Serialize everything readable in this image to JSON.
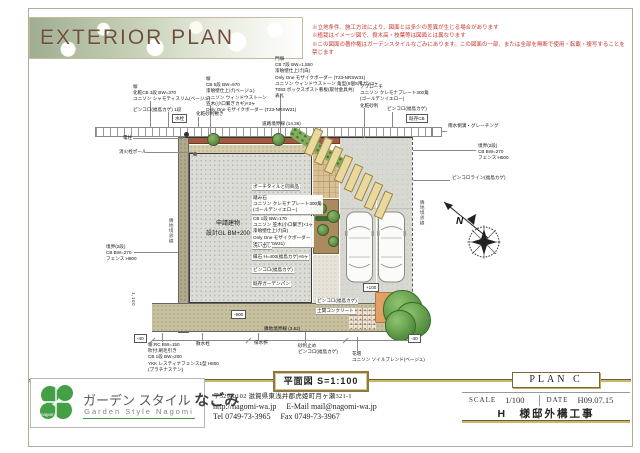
{
  "title": "EXTERIOR PLAN",
  "notes": [
    "※立地条件、施工方法により、図面とは多少の差異が生じる場合があります",
    "※植栽はイメージ図で、樹木高・枝葉等は図面とは異なります",
    "※この図面の著作権はガーデンスタイルなごみにあります。この図面の一部、または全部を無断で使用・転載・複写することを禁じます"
  ],
  "drawing_label": "平面図  S=1:100",
  "compass_north": "N",
  "plan": {
    "annotations": [
      {
        "t": "塀\n化粧CB 3段 BW=370\nユニソン シャモティスリム(ベージュ)",
        "x": 133,
        "y": 84
      },
      {
        "t": "ピンコロ(福島カゲ) 1段",
        "x": 133,
        "y": 107
      },
      {
        "t": "塀\nCB 5段 BW=970\n漆喰壁仕上げ(ベージュ)\nユニソン ウィンドウストーン\n笠木(小口繋ぎカギ)×3ヶ\nOnly One モザイクボーダー (T23-NRSW31)",
        "x": 206,
        "y": 76
      },
      {
        "t": "門塀\nCB 7段 BW=1,550\n漆喰壁仕上げ(白)\nOnly One モザイクボーダー (T23-NRSW31)\nユニソン ウィンドウストーン 角型(6個S用ガ)×3ヶ\nT083 ボックスポスト看板(取付金具共)\n表札",
        "x": 275,
        "y": 56
      },
      {
        "t": "アプローチ\nユニソン クレモナプレート300角\n(ゴールデンイエロー)\n化粧砂利",
        "x": 360,
        "y": 84
      },
      {
        "t": "化粧砂利敷き",
        "x": 196,
        "y": 111
      },
      {
        "t": "ピンコロ(福島カゲ)",
        "x": 387,
        "y": 106
      },
      {
        "t": "既存CB",
        "x": 406,
        "y": 114,
        "cls": "box"
      },
      {
        "t": "水栓",
        "x": 172,
        "y": 114,
        "cls": "box"
      },
      {
        "t": "電柱",
        "x": 123,
        "y": 135
      },
      {
        "t": "消火栓ポール",
        "x": 119,
        "y": 149
      },
      {
        "t": "道路境界線 (14.36)",
        "x": 262,
        "y": 121
      },
      {
        "t": "雨水側溝・グレーチング",
        "x": 448,
        "y": 123
      },
      {
        "t": "境界(2段)\nCB BW=270\nフェンス H500",
        "x": 478,
        "y": 143
      },
      {
        "t": "ピンコロライン(福島カゲ)",
        "x": 452,
        "y": 175
      },
      {
        "t": "隣地境界線",
        "x": 419,
        "y": 200,
        "cls": "vert"
      },
      {
        "t": "隣地境界線",
        "x": 168,
        "y": 218,
        "cls": "vert"
      },
      {
        "t": "境界(2段)\nCB BW=270\nフェンス H800",
        "x": 106,
        "y": 244
      },
      {
        "t": "1,100",
        "x": 130,
        "y": 292,
        "cls": "vert"
      },
      {
        "t": "申請建物\n設計GL BM+200",
        "x": 206,
        "y": 220,
        "cls": "c"
      },
      {
        "t": "ポーチタイルと同商品",
        "x": 252,
        "y": 184,
        "cls": "w"
      },
      {
        "t": "踏み石\nユニソン クレモナプレート300角\n(ゴールデンイエロー)",
        "x": 252,
        "y": 195,
        "cls": "w"
      },
      {
        "t": "CB 1段 BW=170\nユニソン 笠木(小口繋ぎ)×1ヶ\n漆喰壁仕上げ(白)\nOnly One モザイクボーダー\n(T23-NRSW31)",
        "x": 252,
        "y": 216,
        "cls": "w"
      },
      {
        "t": "洗い出し",
        "x": 252,
        "y": 243,
        "cls": "w"
      },
      {
        "t": "縁石 H=400(福島カゲ)×6ヶ",
        "x": 252,
        "y": 254,
        "cls": "w"
      },
      {
        "t": "ピンコロ(福島カゲ)",
        "x": 252,
        "y": 267,
        "cls": "w"
      },
      {
        "t": "既存ガーデンパン",
        "x": 252,
        "y": 281,
        "cls": "w"
      },
      {
        "t": "ピンコロ(福島カゲ)",
        "x": 316,
        "y": 298,
        "cls": "w"
      },
      {
        "t": "土間コンクリート",
        "x": 316,
        "y": 308,
        "cls": "w"
      },
      {
        "t": "+100",
        "x": 363,
        "y": 283,
        "cls": "box"
      },
      {
        "t": "-900",
        "x": 231,
        "y": 310,
        "cls": "box"
      },
      {
        "t": "-40",
        "x": 134,
        "y": 334,
        "cls": "box"
      },
      {
        "t": "-40",
        "x": 408,
        "y": 334,
        "cls": "box"
      },
      {
        "t": "隣地境界線 (3.62)",
        "x": 264,
        "y": 326
      },
      {
        "t": "塀:RC BW=150\n吹付:刷毛引き\nCB 1段 BW=200\nYKK レスティナフェンス1型 H800\n(プラチナステン)",
        "x": 148,
        "y": 342
      },
      {
        "t": "散水栓",
        "x": 196,
        "y": 341
      },
      {
        "t": "排水桝",
        "x": 254,
        "y": 340
      },
      {
        "t": "砂利止め\nピンコロ(福島カゲ)",
        "x": 298,
        "y": 343
      },
      {
        "t": "花壇\nユニソン ソイルブレンド(ベージュ)",
        "x": 352,
        "y": 351
      }
    ],
    "leader_lines": [
      {
        "x": 150,
        "y": 101,
        "h": 26
      },
      {
        "x": 168,
        "y": 112,
        "h": 15
      },
      {
        "x": 210,
        "y": 105,
        "h": 33
      },
      {
        "x": 280,
        "y": 96,
        "h": 42
      },
      {
        "x": 198,
        "y": 117,
        "h": 10
      },
      {
        "x": 364,
        "y": 108,
        "h": 30
      },
      {
        "x": 392,
        "y": 112,
        "h": 15
      },
      {
        "x": 442,
        "y": 131,
        "w": 5
      },
      {
        "x": 413,
        "y": 150,
        "w": 63
      },
      {
        "x": 413,
        "y": 180,
        "w": 37
      },
      {
        "x": 133,
        "y": 138,
        "w": 50
      },
      {
        "x": 146,
        "y": 152,
        "w": 47
      },
      {
        "x": 134,
        "y": 252,
        "w": 44
      },
      {
        "x": 162,
        "y": 333,
        "h": 9
      },
      {
        "x": 202,
        "y": 333,
        "h": 8
      },
      {
        "x": 258,
        "y": 333,
        "h": 7
      },
      {
        "x": 305,
        "y": 332,
        "h": 11
      },
      {
        "x": 357,
        "y": 337,
        "h": 14
      },
      {
        "x": 152,
        "y": 340,
        "w": 260
      },
      {
        "x": 152,
        "y": 337,
        "h": 7,
        "cls": "tick"
      },
      {
        "x": 248,
        "y": 337,
        "h": 7,
        "cls": "tick"
      },
      {
        "x": 345,
        "y": 337,
        "h": 7,
        "cls": "tick"
      },
      {
        "x": 412,
        "y": 337,
        "h": 7,
        "cls": "tick"
      }
    ]
  },
  "footer": {
    "logo": {
      "mark": "nagomi",
      "jp1": "ガーデン スタイル ",
      "jp2": "なごみ",
      "en": "Garden Style Nagomi"
    },
    "postal_address": "〒529-0102 滋賀県東浅井郡虎姫町月ヶ瀬321-1",
    "web": "http://nagomi-wa.jp",
    "email_label": "E-Mail",
    "email": "mail@nagomi-wa.jp",
    "tel_label": "Tel",
    "tel": "0749-73-3965",
    "fax_label": "Fax",
    "fax": "0749-73-3967",
    "plan_code": "PLAN  C",
    "scale_label": "SCALE",
    "scale_value": "1/100",
    "date_label": "DATE",
    "date_value": "H09.07.15",
    "project": "H　様邸外構工事"
  }
}
